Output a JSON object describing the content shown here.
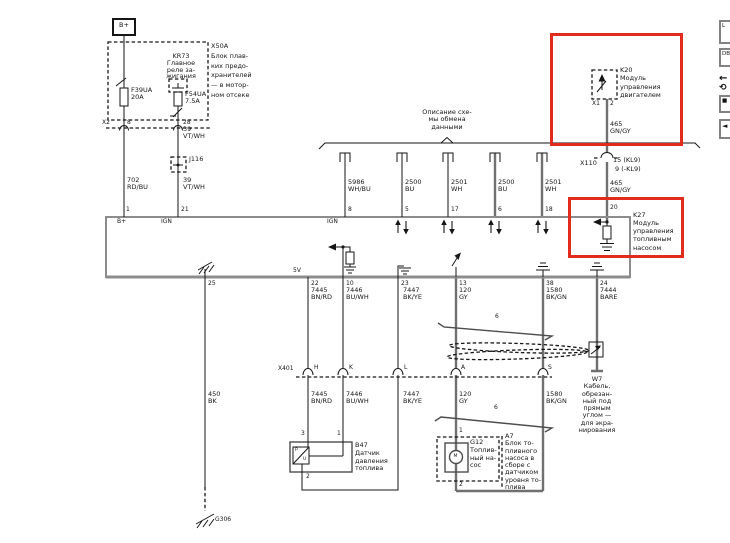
{
  "toolbar": {
    "buttons": [
      "L",
      "DB",
      "←",
      "⟲",
      "■",
      "◄"
    ]
  },
  "diagram": {
    "battery": "B+",
    "fuse_box": "X50A\nБлок плав-\nких предо-\nхранителей\n— в мотор-\nном отсеке",
    "relay": "KR73\nГлавное\nреле за-\nжигания",
    "fuse1": "F39UA\n20A",
    "fuse2": "F54UA\n7.5A",
    "x2": "X2",
    "x2_pin_a": "8",
    "x2_pin_b": "28",
    "wire_702": "702\nRD/BU",
    "wire_39_upper": "39\nVT/WH",
    "junction_j116": "J116",
    "wire_39_lower": "39\nVT/WH",
    "bus_title": "Описание схе-\nмы обмена\nданными",
    "bus_wires": [
      "5986\nWH/BU",
      "2500\nBU",
      "2501\nWH",
      "2500\nBU",
      "2501\nWH"
    ],
    "k20": "K20\nМодуль\nуправления\nдвигателем",
    "k20_conn": "X1",
    "k20_pin": "2",
    "wire_465_upper": "465\nGN/GY",
    "x110": "X110",
    "x110_r1": "15 (KL9)",
    "x110_r2": "9 (-KL9)",
    "wire_465_lower": "465\nGN/GY",
    "k27": "K27\nМодуль\nуправления\nтопливным\nнасосом",
    "top_pins": [
      "1",
      "21",
      "8",
      "5",
      "17",
      "6",
      "18",
      "20"
    ],
    "in_bplus": "B+",
    "in_ign1": "IGN",
    "in_ign2": "IGN",
    "in_5v": "5V",
    "bottom_pins": [
      "25",
      "22",
      "10",
      "23",
      "13",
      "38",
      "24"
    ],
    "wires_upper": [
      "7445\nBN/RD",
      "7446\nBU/WH",
      "7447\nBK/YE",
      "120\nGY",
      "1580\nBK/GN",
      "7444\nBARE"
    ],
    "x401": "X401",
    "x401_pins": [
      "H",
      "K",
      "L",
      "A",
      "S"
    ],
    "wires_lower": [
      "7445\nBN/RD",
      "7446\nBU/WH",
      "7447\nBK/YE",
      "120\nGY",
      "1580\nBK/GN"
    ],
    "wire_450": "450\nBK",
    "g306": "G306",
    "harness_a": "6",
    "harness_b": "6",
    "b47_pin3": "3",
    "b47_pin1": "1",
    "b47_pin2": "2",
    "b47": "B47\nДатчик\nдавления\nтоплива",
    "b47_p": "P",
    "b47_u": "U",
    "g12_pin1": "1",
    "g12_pin2": "2",
    "g12_m": "M",
    "g12": "G12\nТоплив-\nный на-\nсос",
    "a7": "A7\nБлок то-\nпливного\nнасоса в\nсборе с\nдатчиком\nуровня то-\nплива",
    "w7": "W7\nКабель,\nобрезан-\nный под\nпрямым\nуглом —\nдля экра-\nнирования"
  }
}
